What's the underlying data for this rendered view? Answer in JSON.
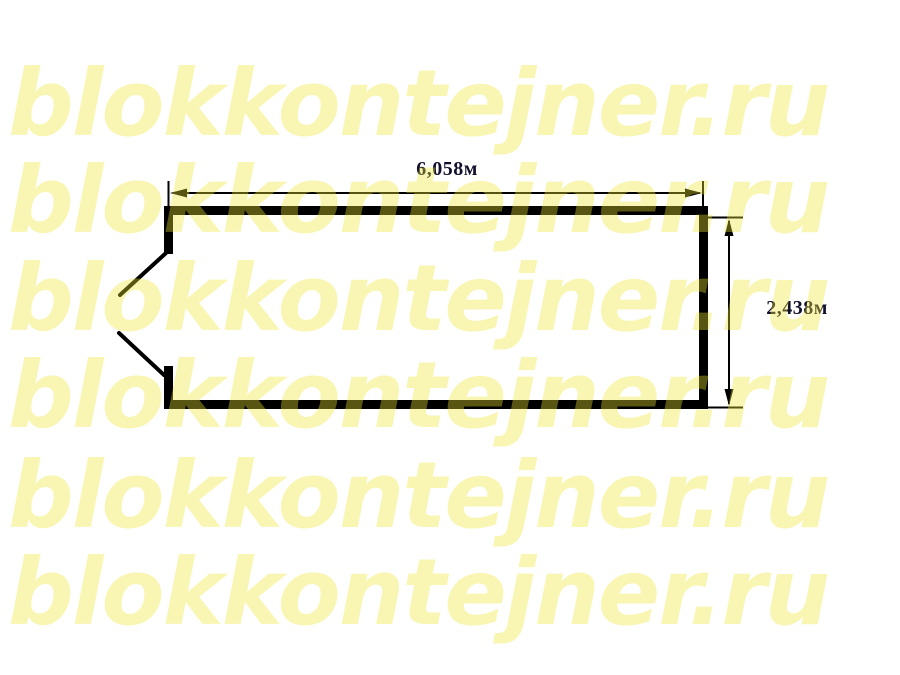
{
  "page": {
    "background_color": "#ffffff",
    "kind": "container floor-plan drawing with site watermark"
  },
  "watermark": {
    "text": "blokkontejner.ru",
    "rows": 6,
    "base_color": "#f0e734",
    "opacity": 0.37,
    "rendered_over_white": "#f8f5bd",
    "rendered_over_black": "#5a540f"
  },
  "diagram": {
    "type": "floor-plan",
    "line_color": "#000000",
    "dimension_text_color": "#10102c",
    "width_label": "6,058м",
    "height_label": "2,438м",
    "features": {
      "walls": "rectangular outline, thick black",
      "door": "double door opening in left wall, both leaves shown swung outward"
    }
  }
}
